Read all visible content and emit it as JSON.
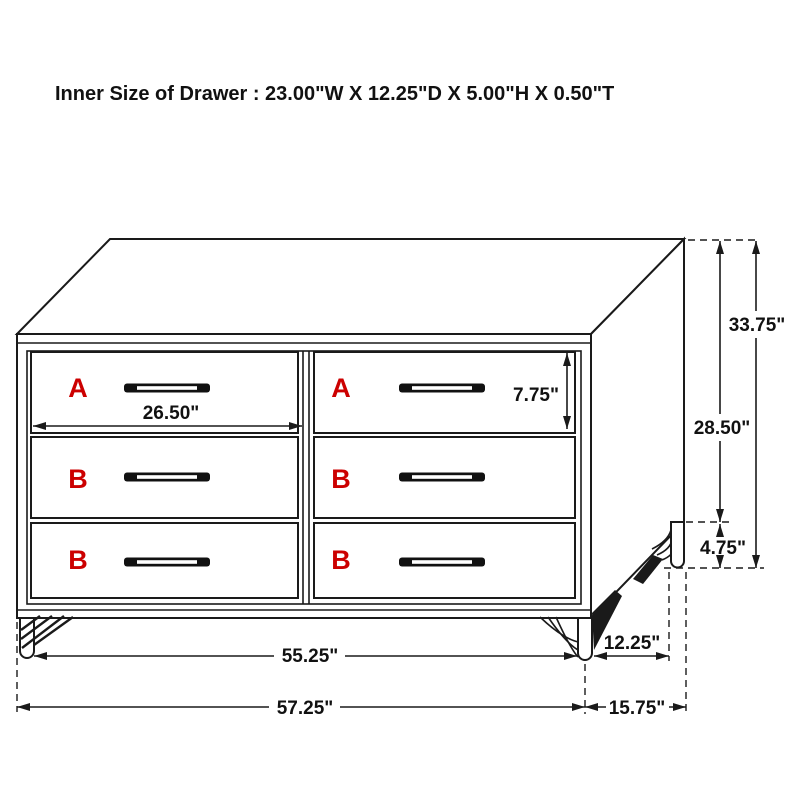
{
  "title": "Inner Size of Drawer : 23.00\"W X 12.25\"D X 5.00\"H X 0.50\"T",
  "colors": {
    "ink": "#1a1a1a",
    "accent_red": "#cc0000",
    "background": "#ffffff"
  },
  "drawer_labels": {
    "top_left": "A",
    "top_right": "A",
    "middle_left": "B",
    "middle_right": "B",
    "bottom_left": "B",
    "bottom_right": "B"
  },
  "dimensions": {
    "drawer_width": "26.50\"",
    "drawer_front_height": "7.75\"",
    "overall_height": "33.75\"",
    "case_height": "28.50\"",
    "leg_height": "4.75\"",
    "width_between_legs": "55.25\"",
    "leg_depth": "12.25\"",
    "overall_width": "57.25\"",
    "overall_depth": "15.75\""
  }
}
